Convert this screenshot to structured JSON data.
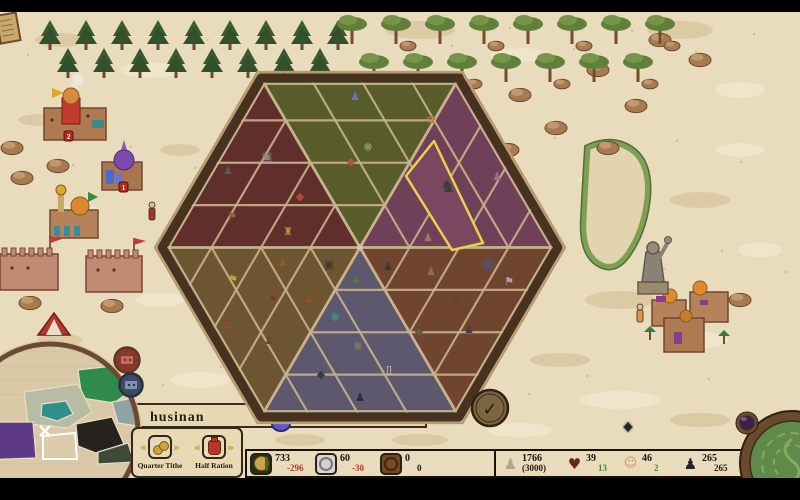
{
  "window": {
    "width": 800,
    "height": 500,
    "letterbox_color": "#000000"
  },
  "hud": {
    "region_label": "husinan",
    "actions": [
      {
        "id": "quarter-tithe",
        "label": "Quarter Tithe"
      },
      {
        "id": "half-ration",
        "label": "Half Ration"
      }
    ],
    "resources": [
      {
        "id": "food",
        "value": "733",
        "delta": "-296",
        "delta_color": "#b5372a"
      },
      {
        "id": "silver",
        "value": "60",
        "delta": "-30",
        "delta_color": "#b5372a"
      },
      {
        "id": "copper",
        "value": "0",
        "delta": "0",
        "delta_color": "#221a12"
      }
    ],
    "stats": [
      {
        "id": "population",
        "value": "1766",
        "sub": "(3000)"
      },
      {
        "id": "loyalty",
        "value": "39",
        "delta": "13",
        "delta_color": "#3f8a36"
      },
      {
        "id": "happiness",
        "value": "46",
        "delta": "2",
        "delta_color": "#3f8a36"
      },
      {
        "id": "soldiers",
        "value": "265",
        "delta": "265",
        "delta_color": "#221a12"
      }
    ],
    "confirm_glyph": "✓"
  },
  "icons": {
    "heart": "♥",
    "population": "♟",
    "face": "☺",
    "soldier": "♟",
    "prev_arrow": "«",
    "next_arrow": "»"
  },
  "board": {
    "cx": 360,
    "cy": 247.5,
    "width": 396,
    "height": 339,
    "frame_color": "#46321f",
    "trim_color": "#b89a6e",
    "grid_color": "#c7b28c",
    "center_dot": "#d8c5a0",
    "wedges": [
      {
        "name": "north",
        "color": "#585c2a"
      },
      {
        "name": "northeast",
        "color": "#6f4058"
      },
      {
        "name": "southeast",
        "color": "#6f452f"
      },
      {
        "name": "south",
        "color": "#5e586e"
      },
      {
        "name": "southwest",
        "color": "#6e5531"
      },
      {
        "name": "northwest",
        "color": "#612f2b"
      }
    ],
    "highlight": {
      "color": "#e8d34a",
      "fill": "#7a4660",
      "points": [
        [
          434,
          141
        ],
        [
          406,
          176
        ],
        [
          452,
          250
        ],
        [
          483,
          243
        ]
      ]
    },
    "items": [
      [
        355,
        96,
        "♟",
        "#6b76b8"
      ],
      [
        368,
        147,
        "❋",
        "#9aa868"
      ],
      [
        351,
        161,
        "◆",
        "#b05a30"
      ],
      [
        431,
        119,
        "✿",
        "#c07830"
      ],
      [
        489,
        127,
        "▣",
        "#a8803c"
      ],
      [
        448,
        188,
        "♞",
        "#3a3d33",
        17
      ],
      [
        497,
        176,
        "♟",
        "#9a7090"
      ],
      [
        488,
        265,
        "☒",
        "#3a5fb0",
        12
      ],
      [
        428,
        237,
        "♟",
        "#9a7a60"
      ],
      [
        300,
        196,
        "◆",
        "#b04a30"
      ],
      [
        288,
        231,
        "♜",
        "#b89440"
      ],
      [
        267,
        156,
        "▣",
        "#8a887c"
      ],
      [
        228,
        170,
        "♟",
        "#5a5a5a"
      ],
      [
        232,
        216,
        "⚑",
        "#8a6a3a"
      ],
      [
        283,
        262,
        "♟",
        "#8a5a30"
      ],
      [
        329,
        264,
        "▣",
        "#44362a"
      ],
      [
        233,
        279,
        "⚑",
        "#c0a030"
      ],
      [
        273,
        299,
        "⚑",
        "#7a3a2a"
      ],
      [
        309,
        299,
        "♟",
        "#905030"
      ],
      [
        228,
        324,
        "⌂",
        "#b04030",
        13
      ],
      [
        269,
        340,
        "♟",
        "#6a4a28"
      ],
      [
        356,
        279,
        "♟",
        "#4a7a40"
      ],
      [
        335,
        317,
        "❋",
        "#3a9a9a"
      ],
      [
        358,
        346,
        "❋",
        "#7a8a50"
      ],
      [
        321,
        374,
        "◆",
        "#3a3a3a"
      ],
      [
        360,
        397,
        "♟",
        "#2a2a38"
      ],
      [
        389,
        369,
        "▯",
        "#d8d0b8"
      ],
      [
        388,
        266,
        "♟",
        "#3a3a3a"
      ],
      [
        431,
        271,
        "♟",
        "#9a6a40"
      ],
      [
        455,
        299,
        "▣",
        "#5a4a30"
      ],
      [
        509,
        281,
        "⚑",
        "#b0a0b8"
      ],
      [
        419,
        331,
        "◆",
        "#6a5a40"
      ],
      [
        469,
        329,
        "♟",
        "#4a3a50"
      ],
      [
        504,
        329,
        "♜",
        "#705a40"
      ]
    ]
  },
  "minimap": {
    "cx": 50,
    "cy": 432,
    "r": 88,
    "ring_color": "#6b4a32",
    "bg": "#d9c9a6",
    "regions": [
      {
        "name": "green-region",
        "color": "#2f8a4e",
        "points": [
          [
            78,
            370
          ],
          [
            122,
            365
          ],
          [
            135,
            388
          ],
          [
            114,
            403
          ],
          [
            82,
            398
          ]
        ]
      },
      {
        "name": "sage-region",
        "color": "#b9bca4",
        "points": [
          [
            24,
            392
          ],
          [
            78,
            384
          ],
          [
            92,
            412
          ],
          [
            68,
            428
          ],
          [
            28,
            424
          ]
        ]
      },
      {
        "name": "teal-lake",
        "color": "#2e8f8d",
        "points": [
          [
            42,
            404
          ],
          [
            66,
            401
          ],
          [
            73,
            414
          ],
          [
            57,
            421
          ],
          [
            41,
            416
          ]
        ]
      },
      {
        "name": "purple-region",
        "color": "#5e3a86",
        "points": [
          [
            -20,
            422
          ],
          [
            33,
            422
          ],
          [
            36,
            458
          ],
          [
            -20,
            460
          ]
        ]
      },
      {
        "name": "black-region",
        "color": "#26221e",
        "points": [
          [
            76,
            424
          ],
          [
            112,
            417
          ],
          [
            124,
            444
          ],
          [
            96,
            453
          ],
          [
            78,
            446
          ]
        ]
      },
      {
        "name": "slate-region",
        "color": "#8fa3a0",
        "points": [
          [
            112,
            402
          ],
          [
            134,
            398
          ],
          [
            138,
            426
          ],
          [
            118,
            423
          ]
        ]
      },
      {
        "name": "darkgreen-region",
        "color": "#3e4a38",
        "points": [
          [
            98,
            452
          ],
          [
            128,
            443
          ],
          [
            134,
            462
          ],
          [
            98,
            464
          ]
        ]
      },
      {
        "name": "selected-region",
        "color": "#dccba8",
        "stroke": "#ffffff",
        "points": [
          [
            43,
            436
          ],
          [
            75,
            433
          ],
          [
            77,
            459
          ],
          [
            43,
            459
          ]
        ]
      }
    ],
    "x_marker": {
      "x": 45,
      "y": 431
    },
    "badges": [
      {
        "name": "minimap-settlement-badge-red",
        "cx": 127,
        "cy": 360,
        "r": 12.5,
        "ring": "#5a3a22",
        "face": "#8a3530",
        "inner": "#c46a55"
      },
      {
        "name": "minimap-settlement-badge-blue",
        "cx": 131,
        "cy": 385,
        "r": 11.5,
        "ring": "#28303f",
        "face": "#3c4a66",
        "inner": "#7e92b4"
      }
    ]
  },
  "map": {
    "sand": "#e8dcbd",
    "blotch_dark": "#d8c49e",
    "blotch_light": "#f2e8d0",
    "speckle": "#b99f77",
    "band": {
      "x": 126,
      "y": 404,
      "w": 300,
      "h": 23,
      "fill": "#e7d8b4",
      "stroke": "#3a2a18"
    },
    "features": [
      {
        "type": "lake",
        "name": "river-bend"
      },
      {
        "type": "rocks",
        "name": "rock-cluster",
        "spots": [
          [
            22,
            178
          ],
          [
            58,
            166
          ],
          [
            12,
            148
          ],
          [
            30,
            303
          ],
          [
            112,
            306
          ],
          [
            520,
            95
          ],
          [
            556,
            128
          ],
          [
            598,
            70
          ],
          [
            636,
            106
          ],
          [
            508,
            150
          ],
          [
            608,
            148
          ],
          [
            700,
            60
          ],
          [
            660,
            40
          ],
          [
            740,
            300
          ]
        ]
      },
      {
        "type": "conifer-row",
        "name": "conifer-forest",
        "x0": 50,
        "x1": 340,
        "rows": [
          20,
          48
        ],
        "step": 36
      },
      {
        "type": "acacia-row",
        "name": "acacia-forest",
        "x0": 352,
        "x1": 660,
        "rows": [
          18,
          56
        ],
        "step": 44
      },
      {
        "type": "settlement",
        "name": "red-town",
        "x": 40,
        "y": 90,
        "badge": "2",
        "badge_xy": [
          64,
          131
        ],
        "palette": [
          "#b07a50",
          "#c23b2e",
          "#d98a3c",
          "#3a8a8a"
        ]
      },
      {
        "type": "settlement",
        "name": "purple-dome-town",
        "x": 98,
        "y": 140,
        "badge": "1",
        "badge_xy": [
          119,
          182
        ],
        "palette": [
          "#a8764e",
          "#7a4ab0",
          "#4a6ad0",
          "#8a5ac0"
        ]
      },
      {
        "type": "settlement",
        "name": "dome-town",
        "x": 46,
        "y": 188,
        "palette": [
          "#b5825a",
          "#d98a2c",
          "#3a8aa0",
          "#c9a96b"
        ]
      },
      {
        "type": "settlement",
        "name": "desert-town",
        "x": 650,
        "y": 284,
        "palette": [
          "#b5825a",
          "#e08a2c",
          "#8a3a8a",
          "#3a7a3a"
        ]
      },
      {
        "type": "walls",
        "name": "castle-walls",
        "x": 0,
        "y": 246,
        "w": 58,
        "h": 44
      },
      {
        "type": "walls",
        "name": "castle-walls",
        "x": 86,
        "y": 248,
        "w": 56,
        "h": 44
      },
      {
        "type": "tent",
        "name": "red-tent",
        "x": 38,
        "y": 313
      },
      {
        "type": "colossus",
        "name": "stone-colossus",
        "x": 640,
        "y": 240
      },
      {
        "type": "figure",
        "name": "elder-figure",
        "x": 152,
        "y": 208,
        "c": "#a03828"
      },
      {
        "type": "figure",
        "name": "villager-figure",
        "x": 640,
        "y": 310,
        "c": "#d89a50"
      },
      {
        "type": "diamond-marker",
        "name": "map-marker-diamond",
        "x": 628,
        "y": 427
      },
      {
        "type": "ledger",
        "name": "ledger-icon",
        "x": -4,
        "y": 16
      },
      {
        "type": "unit-marker",
        "name": "unit-marker",
        "x": 281,
        "y": 424
      }
    ]
  },
  "emblems": {
    "medallion": {
      "cx": 792,
      "cy": 463,
      "r": 47,
      "ring": "#6b4a2e",
      "face": "#5f8a4a",
      "swirl": "#88aa58"
    },
    "orb": {
      "cx": 747,
      "cy": 423,
      "r": 9,
      "ring": "#6b4a2e",
      "face": "#3c2344",
      "glint": "#8a5aa0"
    }
  }
}
